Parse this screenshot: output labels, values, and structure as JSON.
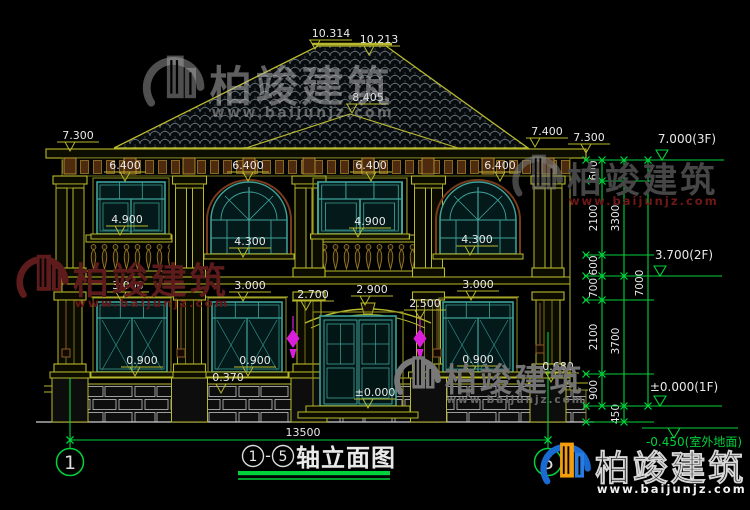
{
  "drawing": {
    "title": {
      "axis_start": "1",
      "separator": "-",
      "axis_end": "5",
      "text": "轴立面图"
    },
    "bottom_dimension": {
      "t": "13500",
      "x": 303,
      "y": 436,
      "x1": 70,
      "x2": 548,
      "ly": 440
    },
    "axis_bubbles": [
      {
        "n": "1",
        "x": 70,
        "y1": 378
      },
      {
        "n": "5",
        "x": 548,
        "y1": 332
      }
    ],
    "dim_labels": [
      {
        "t": "10.314",
        "x": 331,
        "uy": 40,
        "tx": 315
      },
      {
        "t": "10.213",
        "x": 379,
        "uy": 46,
        "tx": 369
      },
      {
        "t": "8.405",
        "x": 368,
        "uy": 104,
        "tx": 352
      },
      {
        "t": "7.300",
        "x": 78,
        "uy": 142,
        "tx": 70
      },
      {
        "t": "7.400",
        "x": 547,
        "uy": 138,
        "tx": 535
      },
      {
        "t": "7.300",
        "x": 589,
        "uy": 144,
        "tx": 586
      },
      {
        "t": "6.400",
        "x": 125,
        "uy": 172,
        "tx": 125
      },
      {
        "t": "6.400",
        "x": 248,
        "uy": 172,
        "tx": 248
      },
      {
        "t": "6.400",
        "x": 371,
        "uy": 172,
        "tx": 371
      },
      {
        "t": "6.400",
        "x": 500,
        "uy": 172,
        "tx": 500
      },
      {
        "t": "4.900",
        "x": 127,
        "uy": 226,
        "tx": 120
      },
      {
        "t": "4.900",
        "x": 370,
        "uy": 228,
        "tx": 358
      },
      {
        "t": "4.300",
        "x": 250,
        "uy": 248,
        "tx": 243
      },
      {
        "t": "4.300",
        "x": 477,
        "uy": 246,
        "tx": 470
      },
      {
        "t": "3.000",
        "x": 128,
        "uy": 292,
        "tx": 121
      },
      {
        "t": "3.000",
        "x": 250,
        "uy": 292,
        "tx": 243
      },
      {
        "t": "3.000",
        "x": 478,
        "uy": 291,
        "tx": 471
      },
      {
        "t": "2.700",
        "x": 313,
        "uy": 301,
        "tx": 306
      },
      {
        "t": "2.900",
        "x": 372,
        "uy": 296,
        "tx": 365
      },
      {
        "t": "2.500",
        "x": 425,
        "uy": 310,
        "tx": 420
      },
      {
        "t": "0.900",
        "x": 142,
        "uy": 367,
        "tx": 135
      },
      {
        "t": "0.900",
        "x": 255,
        "uy": 367,
        "tx": 248
      },
      {
        "t": "0.900",
        "x": 478,
        "uy": 366,
        "tx": 471
      },
      {
        "t": "0.370",
        "x": 228,
        "uy": 384,
        "tx": 221
      },
      {
        "t": "0.680",
        "x": 558,
        "uy": 373,
        "tx": 551
      },
      {
        "t": "±0.000",
        "x": 375,
        "uy": 399,
        "tx": 368
      }
    ],
    "level_markers": [
      {
        "t": "7.000(3F)",
        "x": 687,
        "ty": 143,
        "ly": 160,
        "x1": 646,
        "x2": 724,
        "tri": 662,
        "below": false,
        "green": false
      },
      {
        "t": "3.700(2F)",
        "x": 684,
        "ty": 259,
        "ly": 276,
        "x1": 646,
        "x2": 722,
        "tri": 660,
        "below": false,
        "green": false
      },
      {
        "t": "±0.000(1F)",
        "x": 684,
        "ty": 391,
        "ly": 406,
        "x1": 646,
        "x2": 722,
        "tri": 660,
        "below": false,
        "green": false
      },
      {
        "t": "-0.450(室外地面)",
        "x": 694,
        "ty": 446,
        "ly": 428,
        "x1": 642,
        "x2": 738,
        "tri": 674,
        "below": true,
        "green": true
      }
    ],
    "dim_chains": [
      {
        "x": 602,
        "bounds": [
          160,
          181,
          255,
          276,
          300,
          374,
          406
        ],
        "labels": [
          "600",
          "2100",
          "600",
          "700",
          "2100",
          "900"
        ]
      },
      {
        "x": 624,
        "bounds": [
          160,
          276,
          406,
          422
        ],
        "labels": [
          "3300",
          "3700",
          "450"
        ]
      },
      {
        "x": 648,
        "bounds": [
          160,
          406
        ],
        "labels": [
          "7000"
        ]
      }
    ],
    "extension_line_levels": [
      160,
      181,
      255,
      276,
      300,
      374,
      406,
      422
    ]
  },
  "watermarks": [
    {
      "text": "柏竣建筑",
      "www": "www.baijunjz.com",
      "x": 140,
      "y": 50,
      "s": 1.12,
      "style": "ghost"
    },
    {
      "text": "柏竣建筑",
      "www": "www.baijunjz.com",
      "x": 510,
      "y": 150,
      "s": 0.92,
      "style": "darkgray"
    },
    {
      "text": "柏竣建筑",
      "www": "www.baijunjz.com",
      "x": 14,
      "y": 250,
      "s": 0.95,
      "style": "maroon"
    },
    {
      "text": "柏竣建筑",
      "www": "www.baijunjz.com",
      "x": 392,
      "y": 352,
      "s": 0.85,
      "style": "gray"
    },
    {
      "text": "柏竣建筑",
      "www": "www.baijunjz.com",
      "x": 538,
      "y": 438,
      "s": 0.92,
      "style": "color"
    }
  ],
  "colors": {
    "line_yellow": "#b9b92e",
    "window_teal": "#3fa39a",
    "cad_green": "#00d23c",
    "text_white": "#e9e9e9",
    "lamp_magenta": "#da1eda",
    "arch_maroon": "#7a3b1a",
    "stone_gray": "#c2c2c2"
  }
}
